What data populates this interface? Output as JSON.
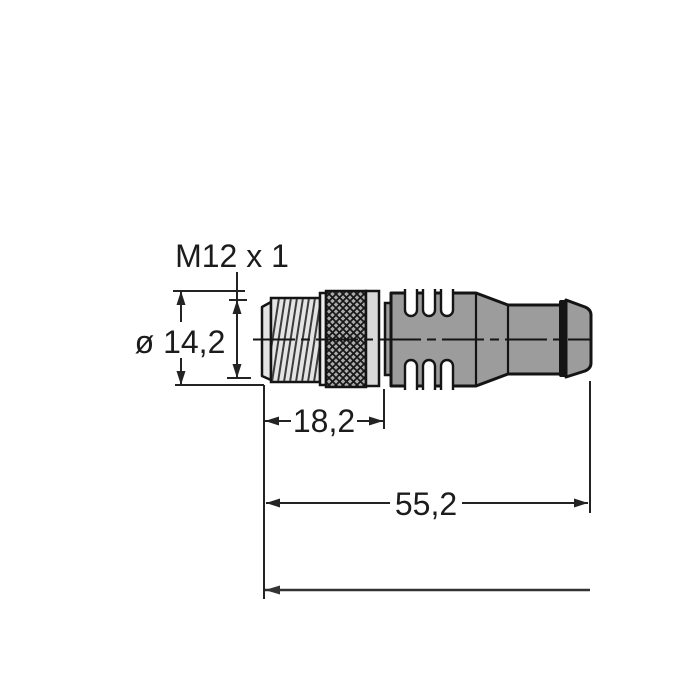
{
  "drawing": {
    "type": "technical-dimension-drawing",
    "subject": "M12 male connector with molded cable body, side view",
    "labels": {
      "thread_spec": "M12 x 1",
      "diameter": "ø 14,2",
      "thread_length": "18,2",
      "overall_length": "55,2"
    },
    "colors": {
      "background": "#ffffff",
      "outline": "#141414",
      "dimension": "#232323",
      "body_gray": "#9c9c9c",
      "washer_gray": "#d9d9d9",
      "thread_gray": "#e4e4e4",
      "rim_gray": "#efefef",
      "knurl_base_gray": "#ababab"
    }
  }
}
